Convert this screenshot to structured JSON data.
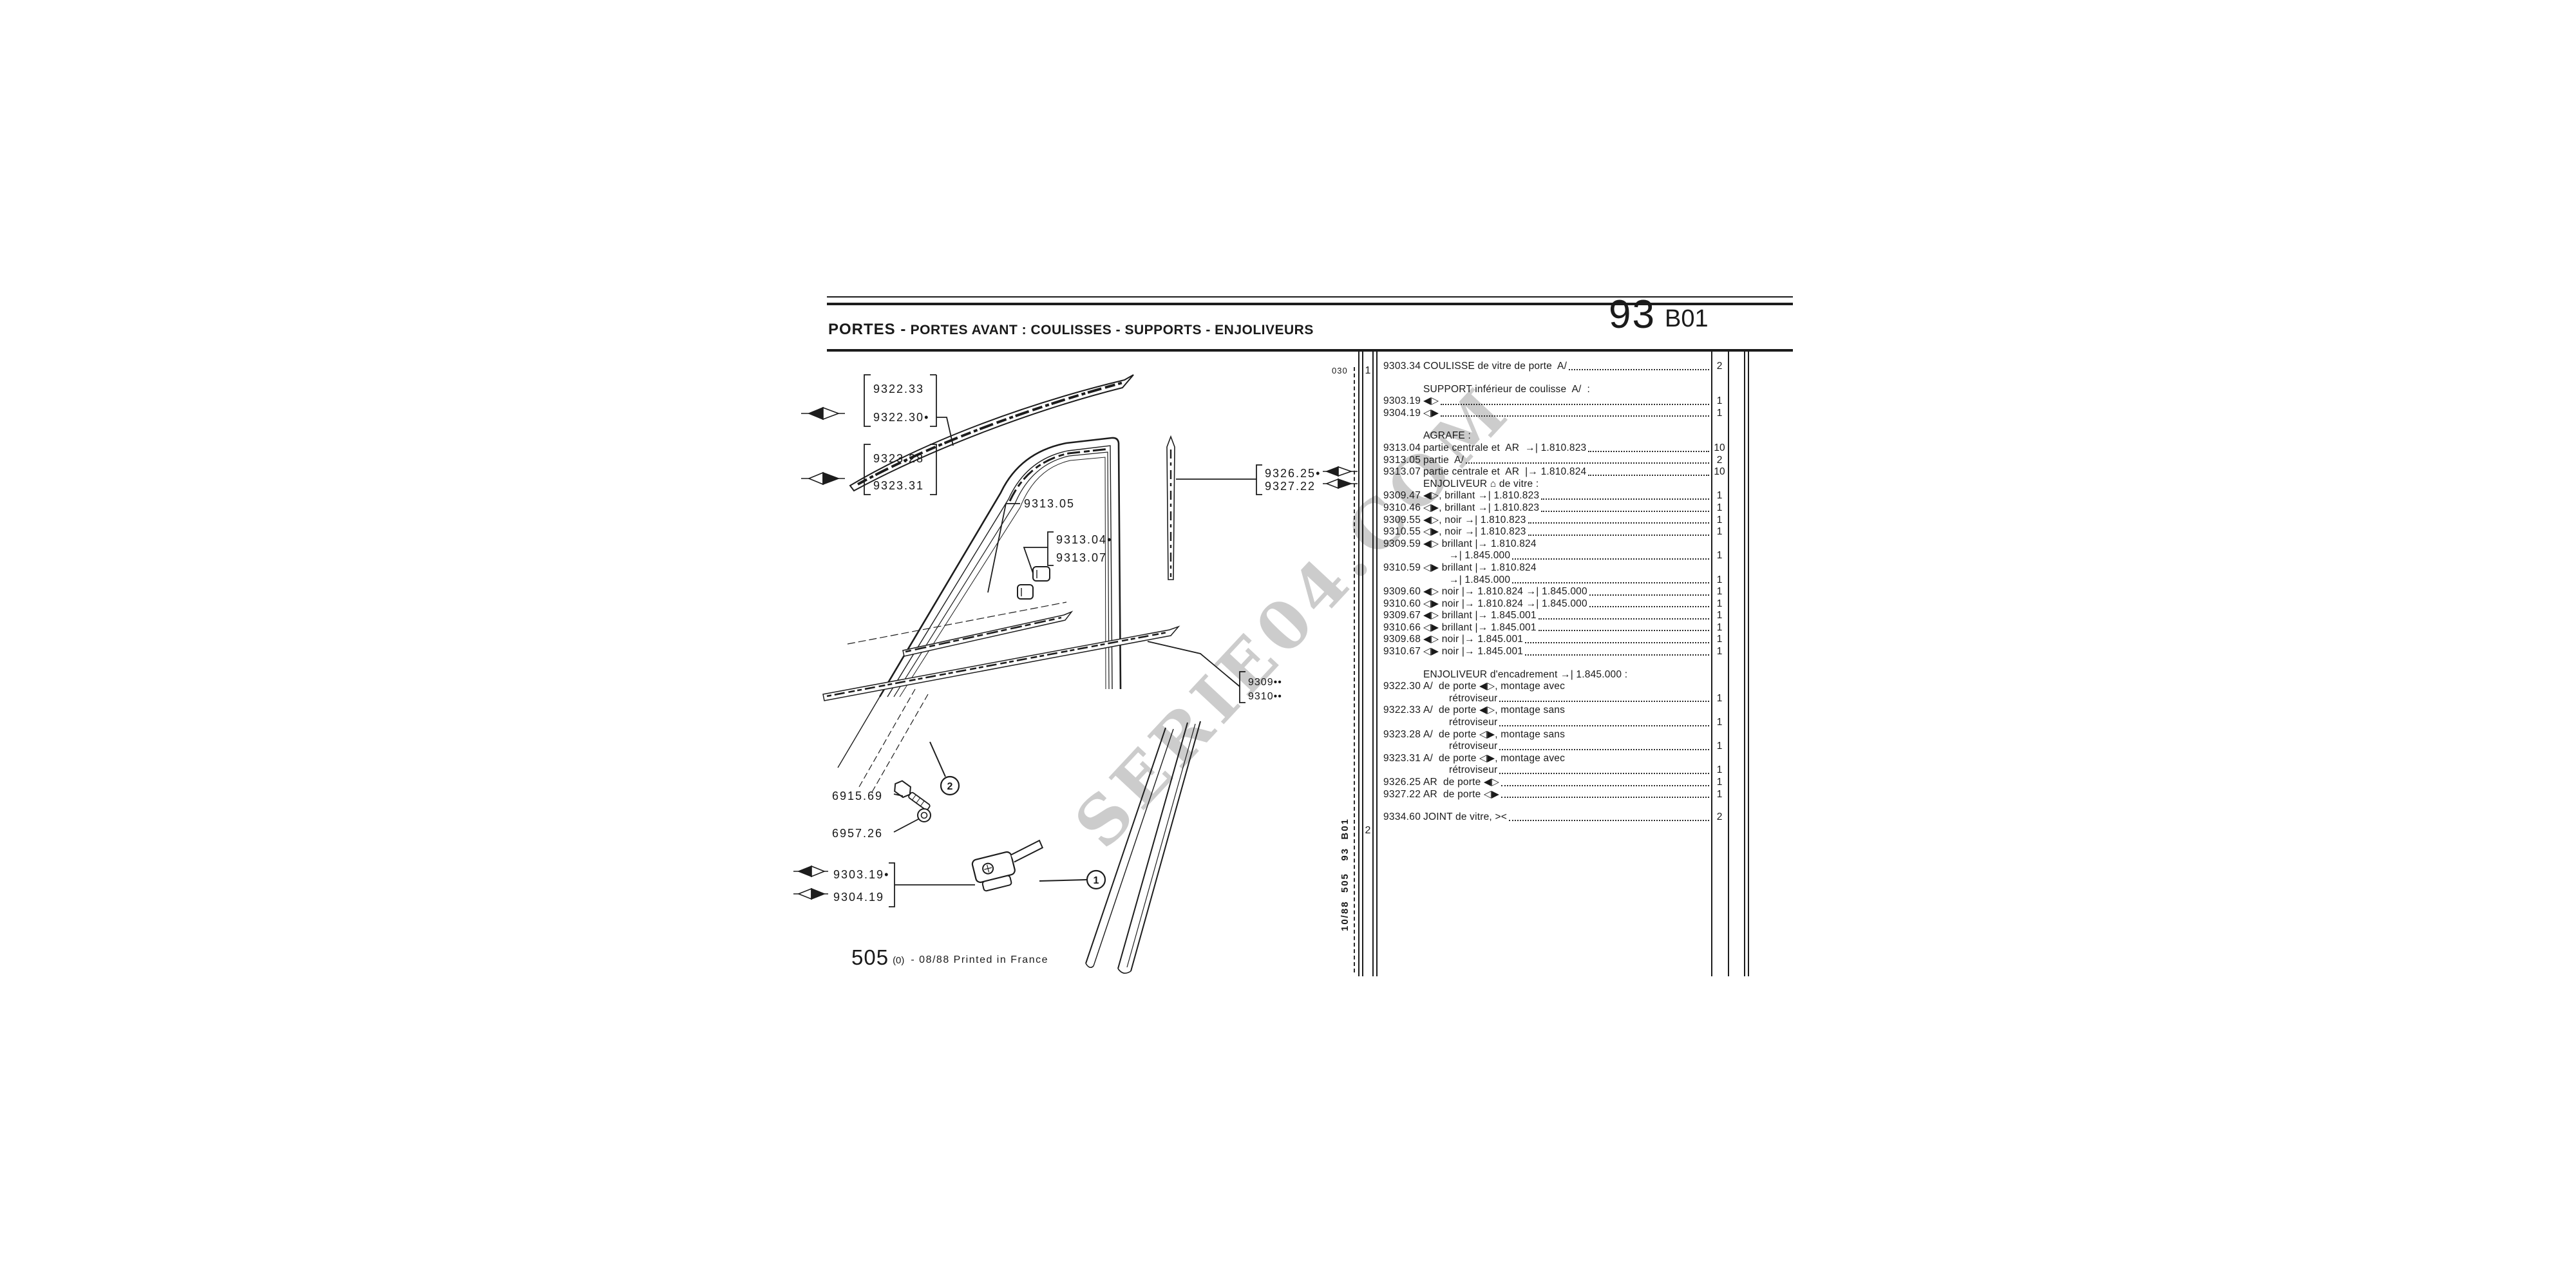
{
  "header": {
    "title_bold": "PORTES -",
    "title_rest": " PORTES AVANT : COULISSES - SUPPORTS - ENJOLIVEURS",
    "page_number": "93",
    "page_code": "B01"
  },
  "side": {
    "top_code": "030",
    "group1": "1",
    "group2": "2",
    "vertical_text": "10/88  505   93  B01"
  },
  "watermark": {
    "text": "SERIE04.COM"
  },
  "footer": {
    "model": "505",
    "edition": "(0)",
    "print": "- 08/88 Printed in France"
  },
  "diagram": {
    "labels": {
      "l9322_33": "9322.33",
      "l9322_30": "9322.30•",
      "l9323_28": "9323.28",
      "l9323_31": "9323.31",
      "l9313_05": "9313.05",
      "l9313_04": "9313.04•",
      "l9313_07": "9313.07",
      "l9326_25": "9326.25•",
      "l9327_22": "9327.22",
      "l9309": "9309••",
      "l9310": "9310••",
      "l6915_69": "6915.69",
      "l6957_26": "6957.26",
      "l9303_19": "9303.19•",
      "l9304_19": "9304.19",
      "callout1": "1",
      "callout2": "2"
    }
  },
  "table": {
    "rows": [
      {
        "ref": "9303.34",
        "text": "COULISSE de vitre de porte  A/",
        "dots": true,
        "qty": "2"
      },
      {
        "gap": true
      },
      {
        "ref": "",
        "text": "SUPPORT inférieur de coulisse  A/  :",
        "dots": false,
        "qty": ""
      },
      {
        "ref": "9303.19",
        "text": "◀▷",
        "dots": true,
        "qty": "1"
      },
      {
        "ref": "9304.19",
        "text": "◁▶",
        "dots": true,
        "qty": "1"
      },
      {
        "gap": true
      },
      {
        "ref": "",
        "text": "AGRAFE :",
        "dots": false,
        "qty": ""
      },
      {
        "ref": "9313.04",
        "text": "partie centrale et  AR  →| 1.810.823",
        "dots": true,
        "qty": "10"
      },
      {
        "ref": "9313.05",
        "text": "partie  A/",
        "dots": true,
        "qty": "2"
      },
      {
        "ref": "9313.07",
        "text": "partie centrale et  AR  |→ 1.810.824",
        "dots": true,
        "qty": "10"
      },
      {
        "ref": "",
        "text": "ENJOLIVEUR ⌂ de vitre :",
        "dots": false,
        "qty": ""
      },
      {
        "ref": "9309.47",
        "text": "◀▷, brillant →| 1.810.823",
        "dots": true,
        "qty": "1"
      },
      {
        "ref": "9310.46",
        "text": "◁▶, brillant →| 1.810.823",
        "dots": true,
        "qty": "1"
      },
      {
        "ref": "9309.55",
        "text": "◀▷, noir →| 1.810.823",
        "dots": true,
        "qty": "1"
      },
      {
        "ref": "9310.55",
        "text": "◁▶, noir →| 1.810.823",
        "dots": true,
        "qty": "1"
      },
      {
        "ref": "9309.59",
        "text": "◀▷ brillant |→ 1.810.824",
        "dots": false,
        "qty": ""
      },
      {
        "ref": "",
        "text": "→| 1.845.000",
        "indent": true,
        "dots": true,
        "qty": "1"
      },
      {
        "ref": "9310.59",
        "text": "◁▶ brillant |→ 1.810.824",
        "dots": false,
        "qty": ""
      },
      {
        "ref": "",
        "text": "→| 1.845.000",
        "indent": true,
        "dots": true,
        "qty": "1"
      },
      {
        "ref": "9309.60",
        "text": "◀▷ noir |→ 1.810.824 →| 1.845.000",
        "dots": true,
        "qty": "1"
      },
      {
        "ref": "9310.60",
        "text": "◁▶ noir |→ 1.810.824 →| 1.845.000",
        "dots": true,
        "qty": "1"
      },
      {
        "ref": "9309.67",
        "text": "◀▷ brillant |→ 1.845.001",
        "dots": true,
        "qty": "1"
      },
      {
        "ref": "9310.66",
        "text": "◁▶ brillant |→ 1.845.001",
        "dots": true,
        "qty": "1"
      },
      {
        "ref": "9309.68",
        "text": "◀▷ noir |→ 1.845.001",
        "dots": true,
        "qty": "1"
      },
      {
        "ref": "9310.67",
        "text": "◁▶ noir |→ 1.845.001",
        "dots": true,
        "qty": "1"
      },
      {
        "gap": true
      },
      {
        "ref": "",
        "text": "ENJOLIVEUR d'encadrement →| 1.845.000 :",
        "dots": false,
        "qty": ""
      },
      {
        "ref": "9322.30",
        "text": "A/  de porte ◀▷, montage avec",
        "dots": false,
        "qty": ""
      },
      {
        "ref": "",
        "text": "rétroviseur",
        "indent": true,
        "dots": true,
        "qty": "1"
      },
      {
        "ref": "9322.33",
        "text": "A/  de porte ◀▷, montage sans",
        "dots": false,
        "qty": ""
      },
      {
        "ref": "",
        "text": "rétroviseur",
        "indent": true,
        "dots": true,
        "qty": "1"
      },
      {
        "ref": "9323.28",
        "text": "A/  de porte ◁▶, montage sans",
        "dots": false,
        "qty": ""
      },
      {
        "ref": "",
        "text": "rétroviseur",
        "indent": true,
        "dots": true,
        "qty": "1"
      },
      {
        "ref": "9323.31",
        "text": "A/  de porte ◁▶, montage avec",
        "dots": false,
        "qty": ""
      },
      {
        "ref": "",
        "text": "rétroviseur",
        "indent": true,
        "dots": true,
        "qty": "1"
      },
      {
        "ref": "9326.25",
        "text": "AR  de porte ◀▷",
        "dots": true,
        "qty": "1"
      },
      {
        "ref": "9327.22",
        "text": "AR  de porte ◁▶",
        "dots": true,
        "qty": "1"
      },
      {
        "gap": true
      },
      {
        "ref": "9334.60",
        "text": "JOINT de vitre, ><",
        "dots": true,
        "qty": "2"
      }
    ]
  }
}
